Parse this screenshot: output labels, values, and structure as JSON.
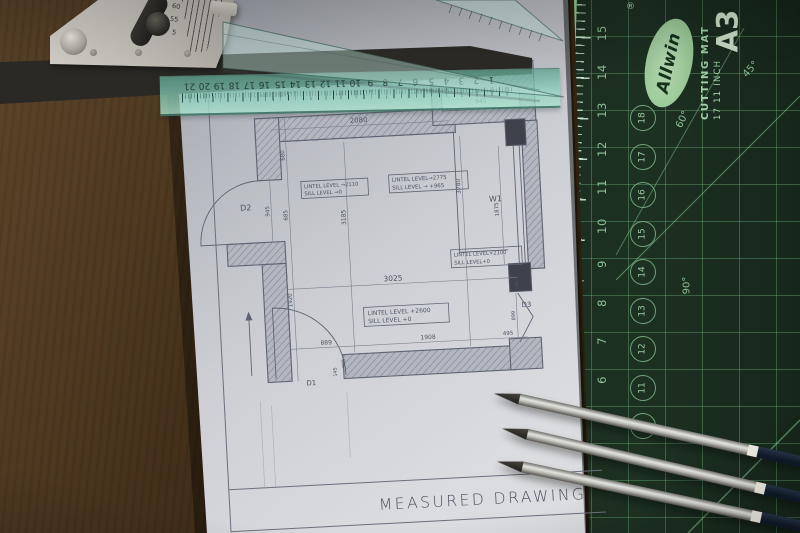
{
  "drawing": {
    "title": "MEASURED DRAWING",
    "door_labels": {
      "d1": "D1",
      "d2": "D2",
      "d3": "D3",
      "w1": "W1"
    },
    "dims": {
      "top_width": "2080",
      "top_right": "945",
      "left_upper": "680",
      "left_door": "945",
      "left_mid": "685",
      "left_lower": "1920",
      "room_height_left": "3185",
      "room_height_right": "3780",
      "window_height": "1875",
      "room_width": "3025",
      "bottom_left": "889",
      "bottom_mid": "1908",
      "bottom_right": "495",
      "right_lower": "899",
      "right_pier": "280",
      "d1_a": "365",
      "d1_b": "145"
    },
    "annotations": {
      "win_left_l1": "LINTEL LEVEL →2110",
      "win_left_l2": "SILL LEVEL →0",
      "win_mid_l1": "LINTEL LEVEL→2775",
      "win_mid_l2": "SILL LEVEL → +965",
      "win_right_l1": "LINTEL LEVEL+2100",
      "win_right_l2": "SILL LEVEL+0",
      "door_bottom_l1": "LINTEL LEVEL +2600",
      "door_bottom_l2": "SILL LEVEL +0"
    }
  },
  "cutting_mat": {
    "brand": "Allwin",
    "registered": "®",
    "product_line1": "CUTTING MAT",
    "product_line2": "17  11 INCH",
    "size": "A3",
    "edge_numbers": [
      "15",
      "14",
      "13",
      "12",
      "11",
      "10",
      "9",
      "8",
      "7",
      "6",
      "5"
    ],
    "circle_numbers": [
      "18",
      "17",
      "16",
      "15",
      "14",
      "13",
      "12",
      "11",
      "10"
    ],
    "angle_45": "45°",
    "angle_60": "60°",
    "angle_90": "90°"
  },
  "scale_ruler": {
    "numbers": [
      "21",
      "20",
      "19",
      "18",
      "17",
      "16",
      "15",
      "14",
      "13",
      "12",
      "11",
      "10",
      "9",
      "8",
      "7",
      "6",
      "5",
      "4",
      "3",
      "2",
      "1"
    ]
  },
  "protractor": {
    "scale_labels": [
      "60",
      "55",
      "5"
    ]
  }
}
